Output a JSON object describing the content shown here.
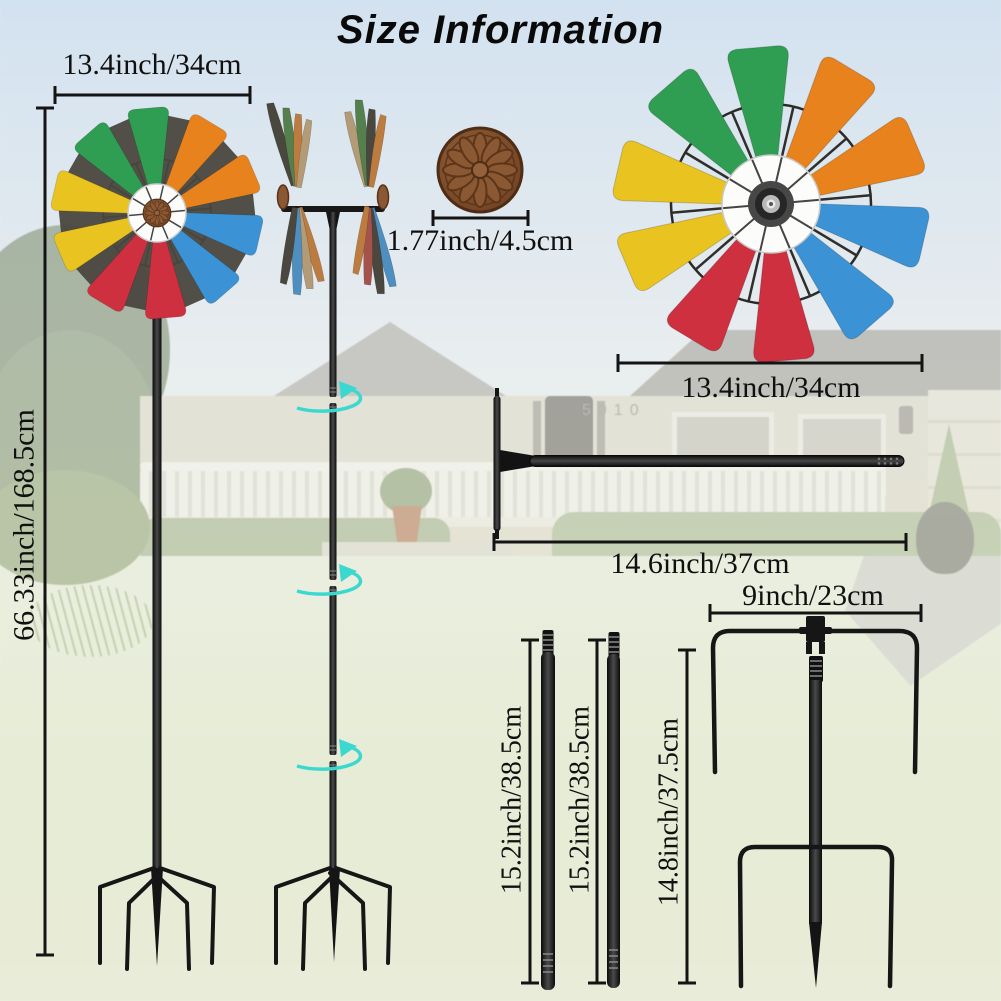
{
  "title": "Size Information",
  "background": {
    "house_number": "5010"
  },
  "colors": {
    "green": "#2f9e53",
    "orange": "#e8821c",
    "blue": "#3b93d6",
    "red": "#cf3040",
    "yellow": "#e9c31f",
    "dark_blade": "#4a473f",
    "metal_black": "#181818",
    "cap_brown": "#8a5833",
    "cap_brown_dark": "#5a3017",
    "cyan": "#3bd8d0",
    "dim_line": "#141414",
    "side_green": "#55804d",
    "side_orange": "#bc7c40",
    "side_tan": "#b29b76",
    "side_blue": "#4f8fc0",
    "side_red": "#a5524b"
  },
  "dims": {
    "left_wheel_width": "13.4inch/34cm",
    "overall_height": "66.33inch/168.5cm",
    "cap_diameter": "1.77inch/4.5cm",
    "wheel_width": "13.4inch/34cm",
    "rod_length": "14.6inch/37cm",
    "segment1_length": "15.2inch/38.5cm",
    "segment2_length": "15.2inch/38.5cm",
    "stake_length": "14.8inch/37.5cm",
    "stake_width": "9inch/23cm"
  }
}
